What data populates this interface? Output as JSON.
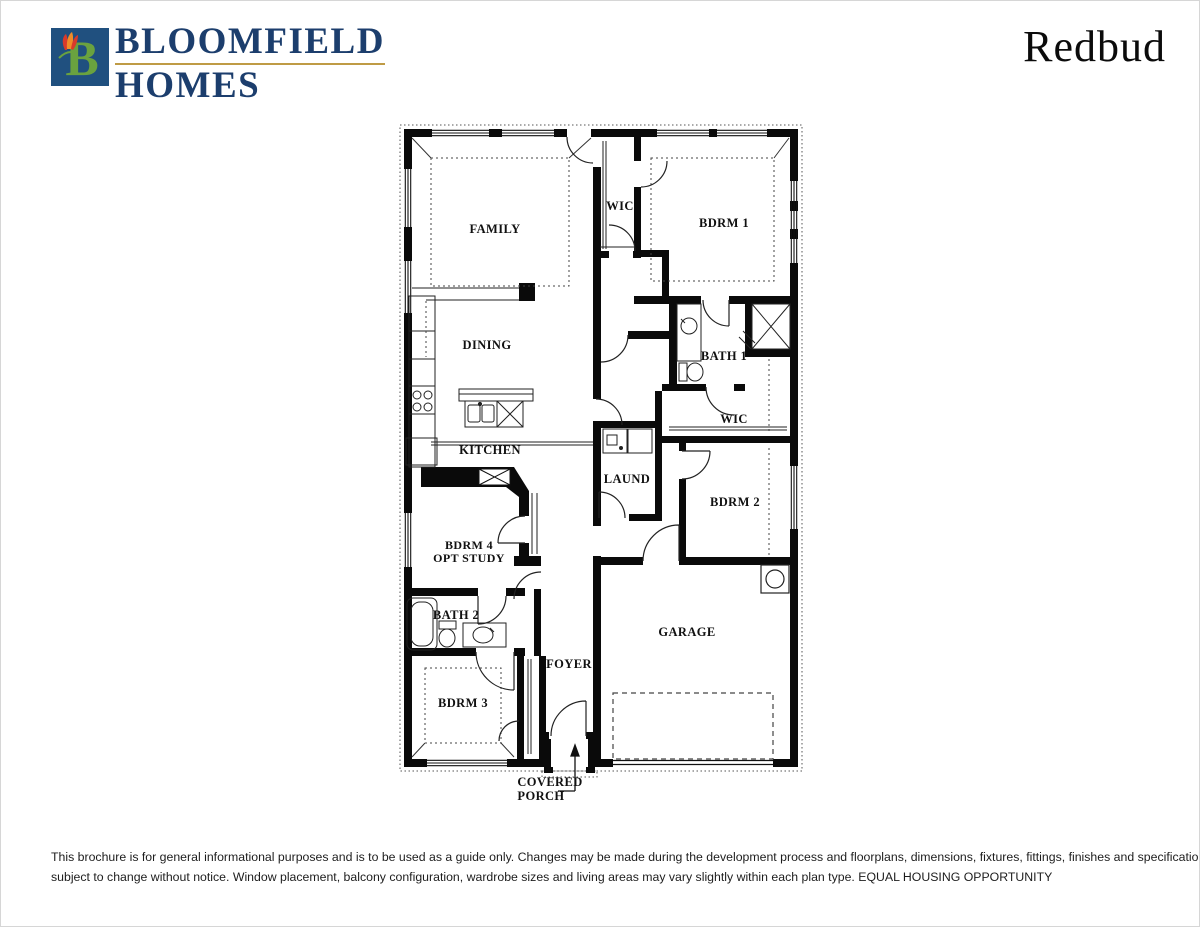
{
  "header": {
    "logo_letter": "B",
    "company_line1": "BLOOMFIELD",
    "company_line2": "HOMES",
    "plan_name": "Redbud"
  },
  "floorplan": {
    "rooms": {
      "family": "FAMILY",
      "wic1": "WIC",
      "bdrm1": "BDRM 1",
      "dining": "DINING",
      "kitchen": "KITCHEN",
      "bath1": "BATH 1",
      "wic2": "WIC",
      "laundry": "LAUND",
      "bdrm2": "BDRM 2",
      "bdrm4_line1": "BDRM 4",
      "bdrm4_line2": "OPT STUDY",
      "bath2": "BATH 2",
      "bdrm3": "BDRM 3",
      "foyer": "FOYER",
      "garage": "GARAGE",
      "porch_line1": "COVERED",
      "porch_line2": "PORCH"
    }
  },
  "footer": {
    "disclaimer_line1": "This brochure is for general informational purposes and is to be used as a guide only. Changes may be made during the development process and floorplans, dimensions, fixtures, fittings, finishes and specifications are",
    "disclaimer_line2": "subject to change without notice. Window placement, balcony configuration, wardrobe sizes and living areas may vary slightly within each plan type.  EQUAL HOUSING OPPORTUNITY"
  },
  "colors": {
    "brand_navy": "#1c3e6d",
    "brand_gold": "#bf9b45",
    "logo_blue": "#20507f",
    "logo_green": "#6aa23f",
    "tulip_orange": "#f08c28",
    "tulip_red": "#d93a2b",
    "wall_black": "#0a0a0a"
  }
}
